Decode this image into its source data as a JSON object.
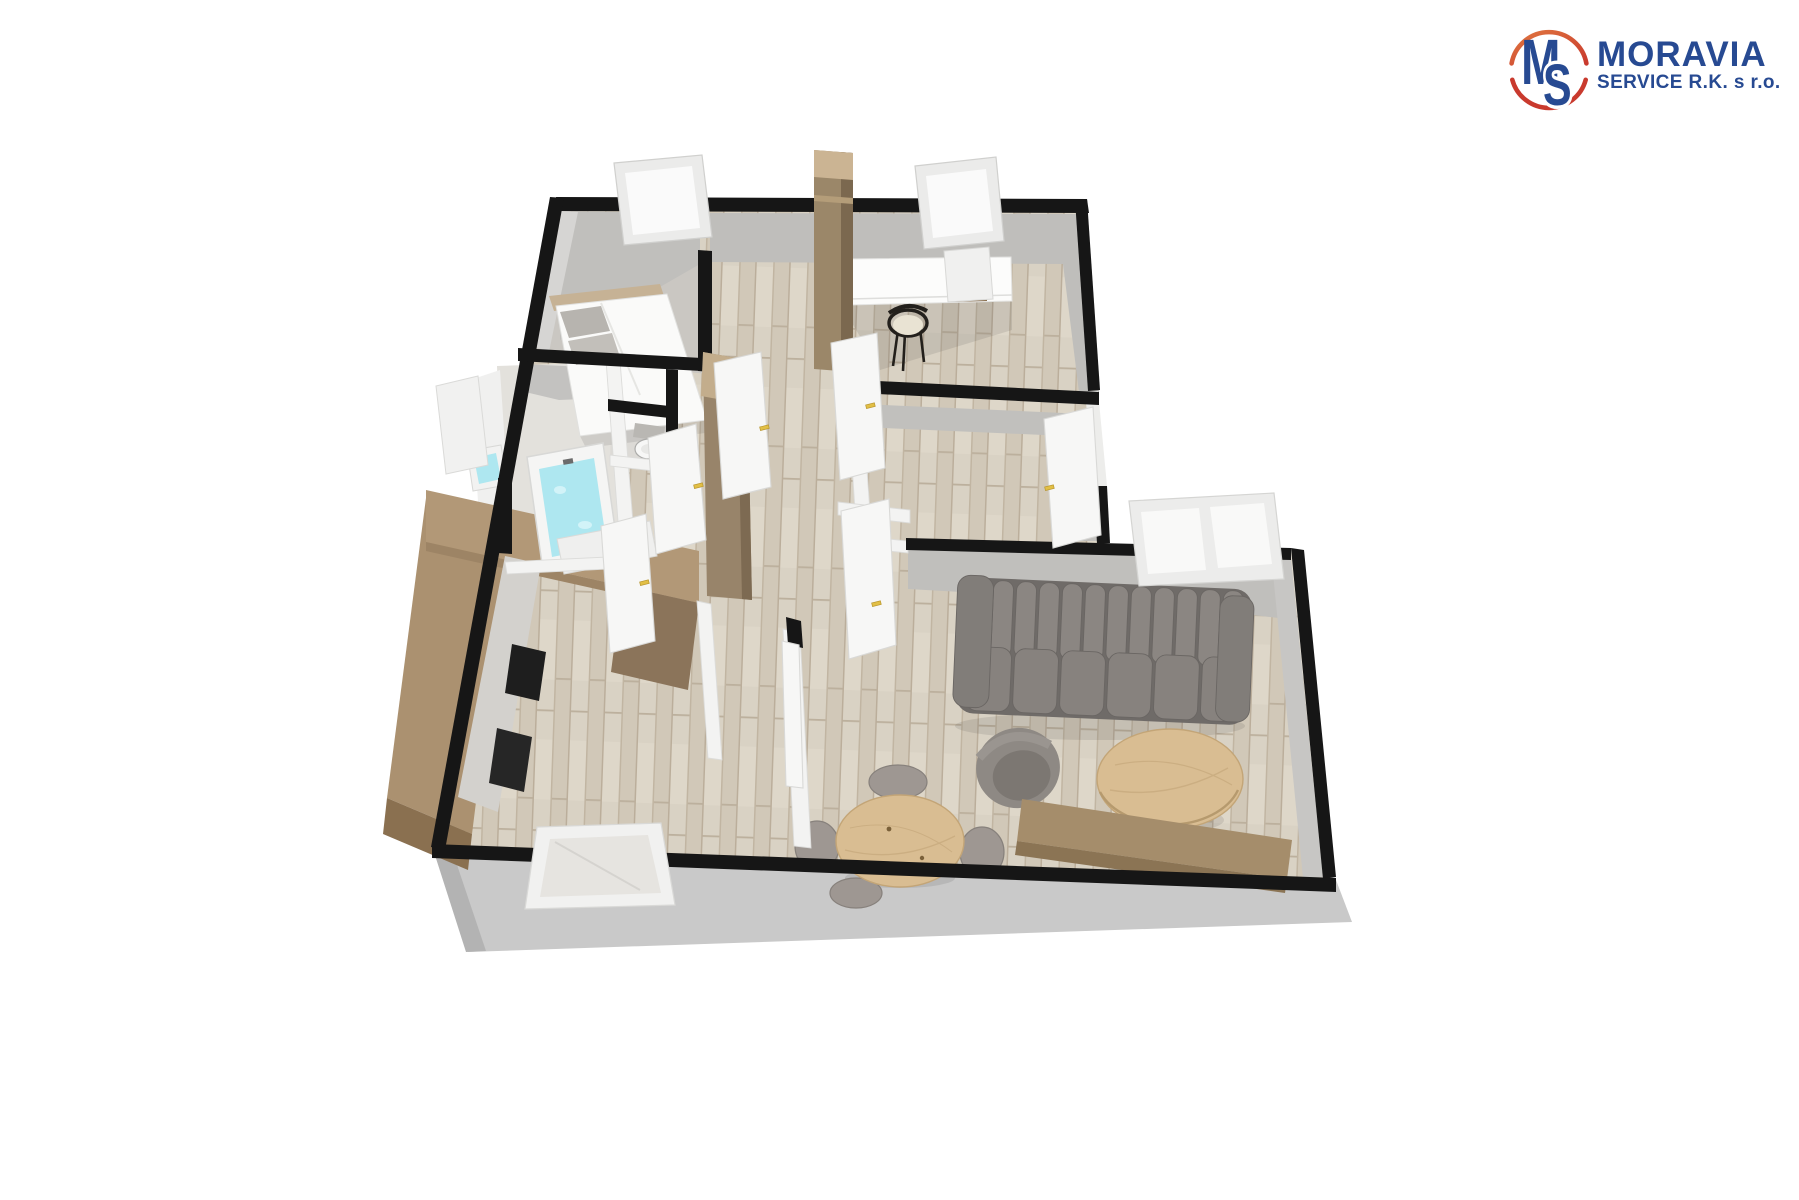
{
  "logo": {
    "monogram_m": "M",
    "monogram_s": "S",
    "name": "MORAVIA",
    "subtitle": "SERVICE R.K. s r.o.",
    "colors": {
      "blue": "#274a92",
      "red": "#cf4434",
      "orange": "#e0763f"
    }
  },
  "floor_plan": {
    "type": "3d-floor-plan-render",
    "view": "top-down perspective (dollhouse view)",
    "rooms": [
      {
        "id": "bedroom",
        "label": "bedroom (top-left)"
      },
      {
        "id": "study",
        "label": "study / second bedroom (top-right)"
      },
      {
        "id": "hallway",
        "label": "central hallway"
      },
      {
        "id": "bathroom",
        "label": "bathroom with bathtub"
      },
      {
        "id": "wc",
        "label": "separate WC"
      },
      {
        "id": "kitchen",
        "label": "kitchen with U-shaped cabinets (bottom-left)"
      },
      {
        "id": "dining-area",
        "label": "dining area (bottom-center)"
      },
      {
        "id": "living-room",
        "label": "living room (bottom-right)"
      }
    ],
    "furniture": [
      "double bed with headboard and pillows",
      "white desk with cabinet and black chair",
      "chimney / tall column",
      "tall hallway wardrobe",
      "bathtub filled with water",
      "washbasin",
      "bathroom vanity",
      "toilet",
      "U-shaped kitchen counter with black appliances",
      "gray channel-tufted sofa",
      "gray armchair",
      "round wooden coffee table",
      "wooden sideboard",
      "round dining table with four gray chairs"
    ],
    "fixtures": {
      "windows": 5,
      "doors_open": 7,
      "door_handle_color": "#e2bf45"
    },
    "palette": {
      "exterior_wall": "#161616",
      "interior_wall_face": "#bfbebb",
      "partition_wall": "#f3f3f2",
      "wood_floor": "#d9d2c4",
      "kitchen_wood": "#ab9170",
      "sofa_gray": "#8b8682",
      "table_wood": "#d9bd92",
      "water_cyan": "#aee7f0",
      "plinth_gray": "#c9c9c9"
    }
  }
}
